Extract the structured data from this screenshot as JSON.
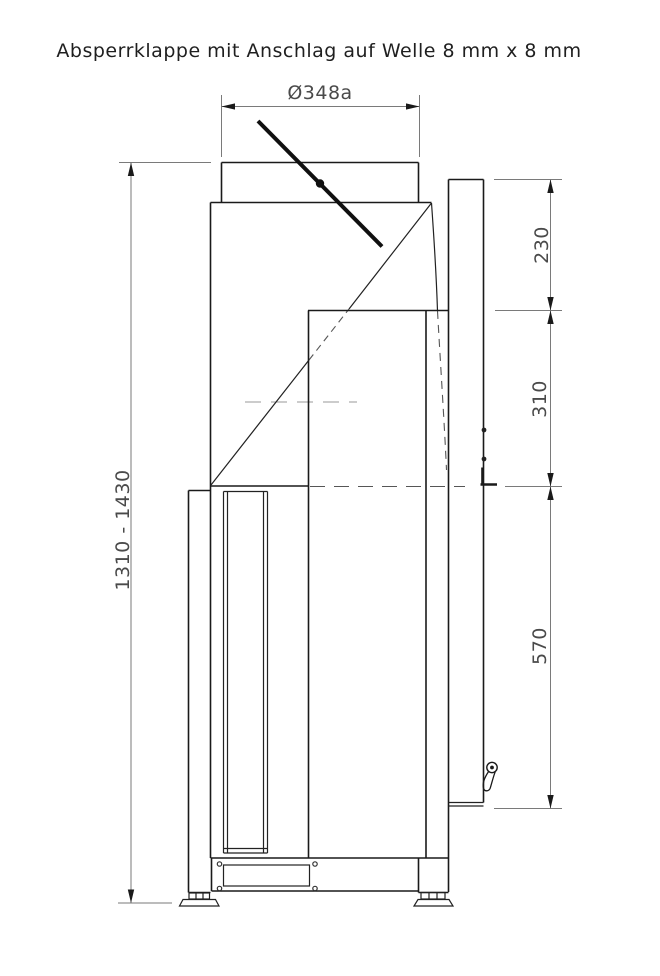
{
  "title": "Absperrklappe mit Anschlag auf Welle 8 mm x 8 mm",
  "dimensions": {
    "top_diameter": "Ø348a",
    "overall_height": "1310 - 1430",
    "upper_right": "230",
    "middle_right": "310",
    "lower_right": "570"
  },
  "colors": {
    "object_line": "#1a1a1a",
    "dimension_line": "#7a7a7a",
    "background": "#ffffff"
  }
}
